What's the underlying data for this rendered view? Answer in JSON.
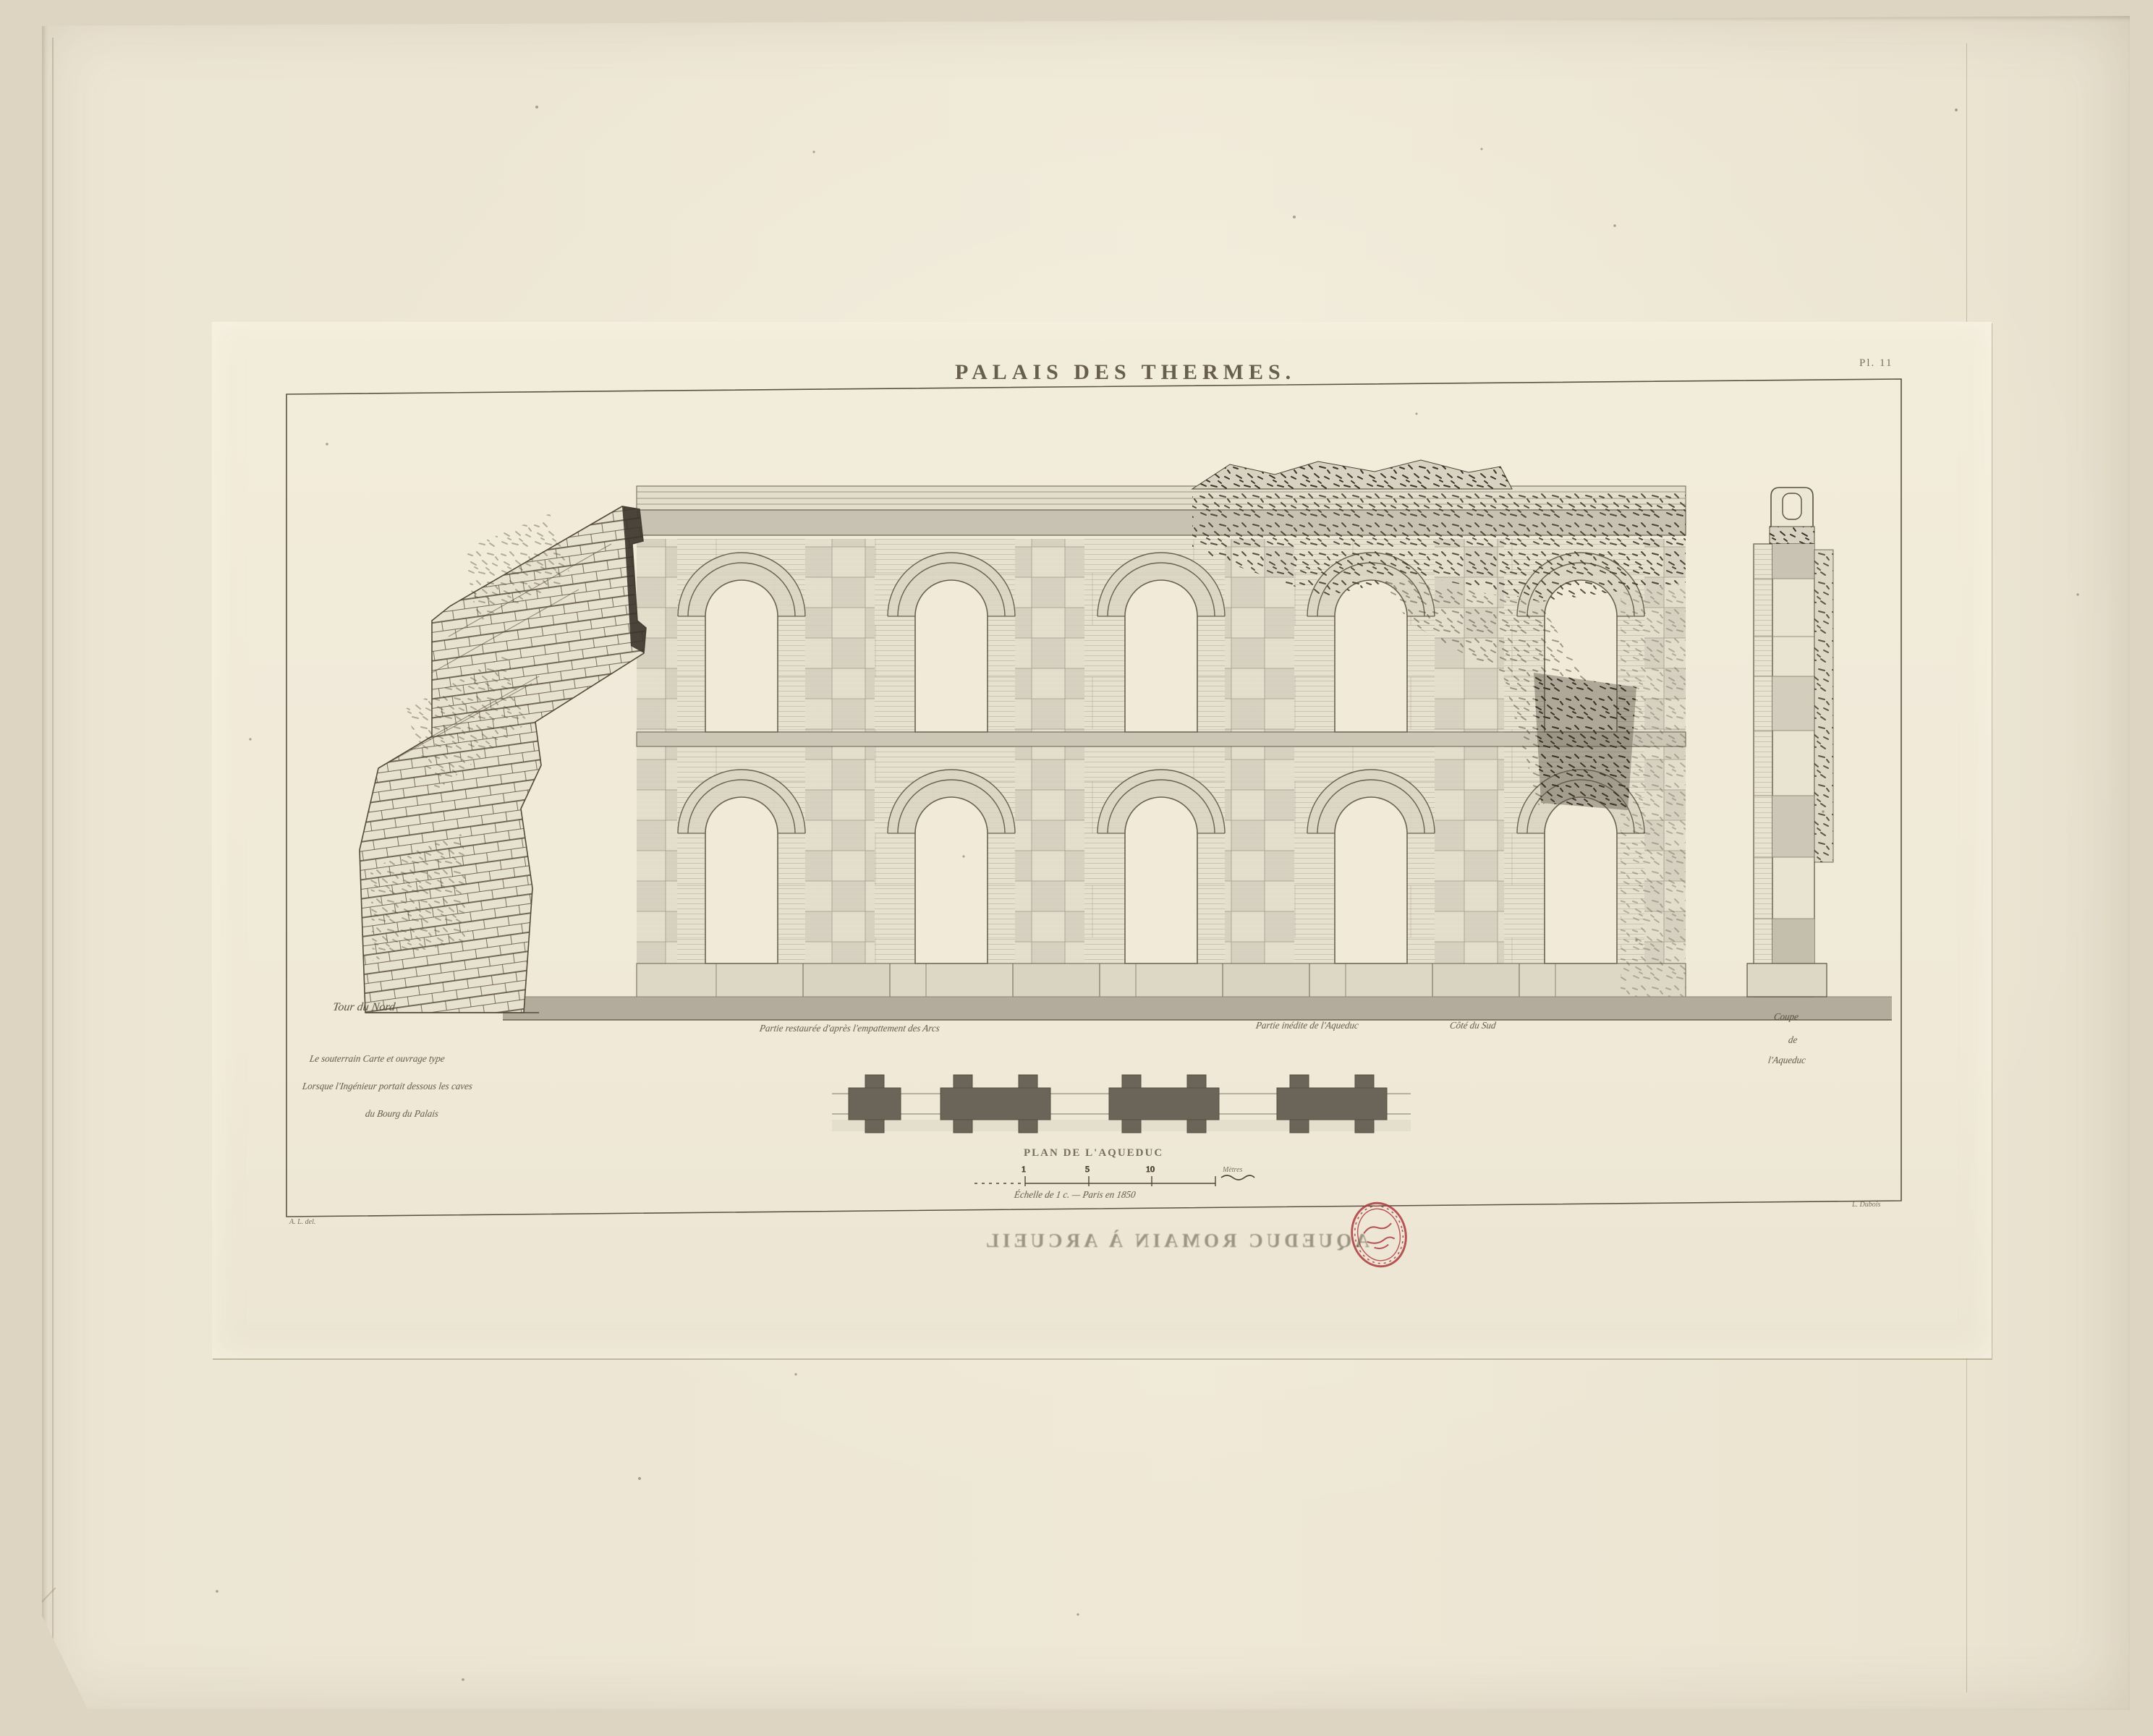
{
  "plate": {
    "title": "PALAIS DES THERMES.",
    "plate_number": "Pl. 11",
    "captions": {
      "tower_label": "Tour du Nord",
      "note_lines": [
        "Le souterrain Carte et ouvrage type",
        "Lorsque l'Ingénieur portait dessous les caves",
        "du Bourg du Palais"
      ],
      "restored_caption": "Partie restaurée d'après l'empattement des Arcs",
      "unpublished_caption": "Partie inédite de l'Aqueduc",
      "side_caption": "Côté du Sud",
      "section_caption_lines": [
        "Coupe",
        "de",
        "l'Aqueduc"
      ],
      "plan_title": "PLAN DE L'AQUEDUC",
      "scale_note": "Échelle de 1 c. — Paris en 1850",
      "scale_unit": "Mètres",
      "left_credit": "A. L. del.",
      "right_credit": "L. Dubois"
    },
    "scale_ticks": [
      "1",
      "5",
      "10"
    ],
    "ghost_text": "AQUEDUC ROMAIN À ARCUEIL",
    "colors": {
      "background": "#ddd5c2",
      "sheet": "#ece5d3",
      "plate_paper": "#f1ead9",
      "ink": "#4f463a",
      "wall_gray": "#d5cfbf",
      "ground_band": "#b3ac9d",
      "stamp_red": "#ad3a3e"
    }
  }
}
